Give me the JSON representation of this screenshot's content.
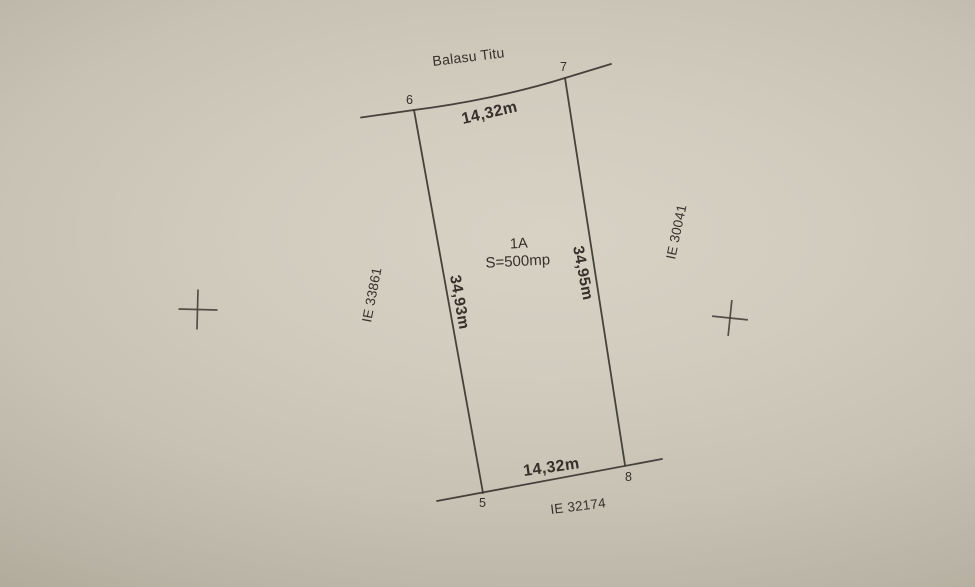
{
  "plan": {
    "owner_top": "Balasu Titu",
    "parcel": {
      "id": "1A",
      "area": "S=500mp"
    },
    "dimensions": {
      "top": "14,32m",
      "bottom": "14,32m",
      "left": "34,93m",
      "right": "34,95m"
    },
    "corners": {
      "p5": "5",
      "p6": "6",
      "p7": "7",
      "p8": "8"
    },
    "neighbors": {
      "left": "IE 33861",
      "right": "IE 30041",
      "bottom": "IE 32174"
    },
    "colors": {
      "paper_light": "#d8d2c5",
      "paper_dark": "#a09a8b",
      "ink": "#34302a"
    }
  }
}
